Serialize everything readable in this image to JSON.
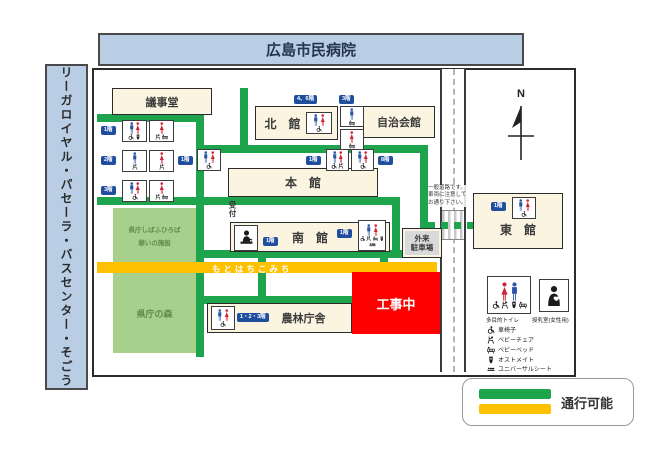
{
  "banner": {
    "title": "広島市民病院"
  },
  "left_bar": {
    "label": "リーガロイヤル・パセーラ・バスセンター・そごう"
  },
  "compass": {
    "north": "N"
  },
  "buildings": {
    "gijido": "議事堂",
    "kitakan": "北　館",
    "jichikaikan": "自治会館",
    "honkan": "本　館",
    "minamikan": "南　館",
    "higashikan": "東　館",
    "norin": "農林庁舎",
    "koji": "工事中",
    "gairai_1": "外来",
    "gairai_2": "駐車場",
    "shibafu_1": "県庁しばふひろば",
    "shibafu_2": "憩いの施設",
    "mori": "県庁の森"
  },
  "labels": {
    "uketsuke": "受付",
    "road_notice_1": "一般道路です。",
    "road_notice_2": "車両に注意して",
    "road_notice_3": "お通り下さい。",
    "yellow_path": "もとはちこみち"
  },
  "badges": {
    "f1": "1階",
    "f2": "2階",
    "f3": "3階",
    "f8": "8階",
    "f46": "4、6階",
    "f123": "1・2・3階"
  },
  "legend": {
    "multi_toilet": "多目的トイレ",
    "nursing": "授乳室(女性用)",
    "items": [
      {
        "icon": "wheelchair-icon",
        "label": "車椅子"
      },
      {
        "icon": "baby-chair-icon",
        "label": "ベビーチェア"
      },
      {
        "icon": "baby-bed-icon",
        "label": "ベビーベッド"
      },
      {
        "icon": "ostomate-icon",
        "label": "オストメイト"
      },
      {
        "icon": "universal-sheet-icon",
        "label": "ユニバーサルシート"
      }
    ],
    "passable": "通行可能"
  },
  "colors": {
    "path_green": "#1ea44c",
    "path_yellow": "#ffc000",
    "construction_red": "#fe0000",
    "banner_blue": "#b9cde4",
    "badge_navy": "#1f4e9f",
    "area_green": "#a8d08d"
  }
}
